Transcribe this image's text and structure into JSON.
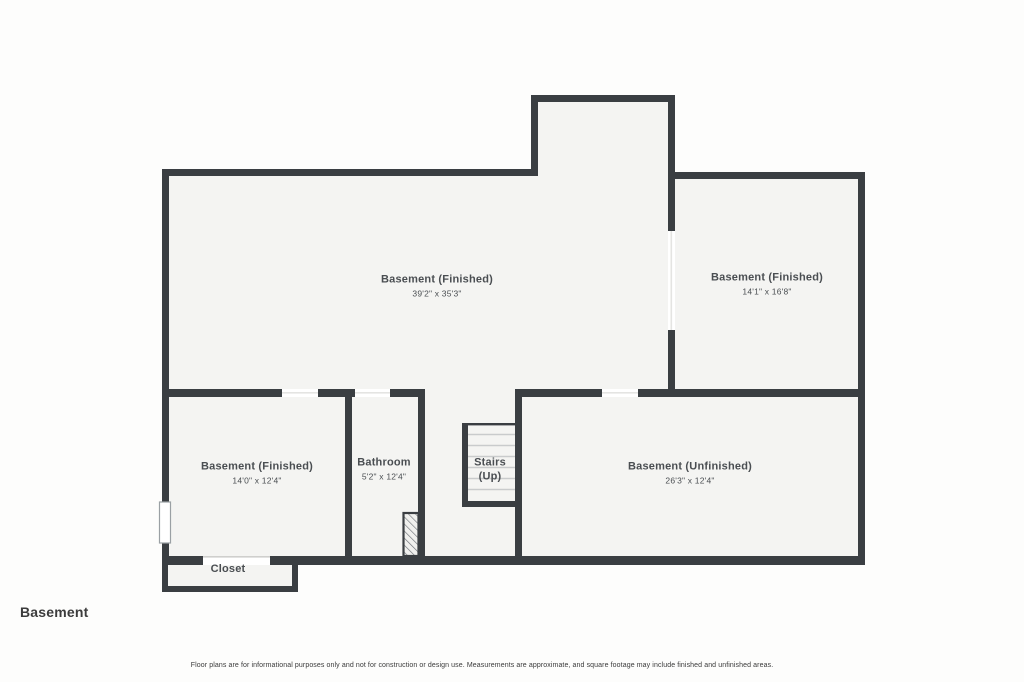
{
  "title": {
    "label": "Basement"
  },
  "disclaimer": {
    "text": "Floor plans are for informational purposes only and not for construction or design use. Measurements are approximate, and square footage may include finished and unfinished areas."
  },
  "rooms": {
    "basement_finished_main": {
      "name": "Basement (Finished)",
      "dims": "39'2\" x 35'3\""
    },
    "basement_finished_right": {
      "name": "Basement (Finished)",
      "dims": "14'1\" x 16'8\""
    },
    "basement_finished_lower": {
      "name": "Basement (Finished)",
      "dims": "14'0\" x 12'4\""
    },
    "bathroom": {
      "name": "Bathroom",
      "dims": "5'2\" x 12'4\""
    },
    "stairs": {
      "name": "Stairs",
      "direction": "(Up)"
    },
    "basement_unfinished": {
      "name": "Basement (Unfinished)",
      "dims": "26'3\" x 12'4\""
    },
    "closet": {
      "name": "Closet"
    }
  },
  "colors": {
    "wall": "#3a3e42",
    "floor": "#f4f4f2",
    "opening": "#ffffff",
    "tread": "#c9cbcc",
    "text": "#4a4e52"
  }
}
